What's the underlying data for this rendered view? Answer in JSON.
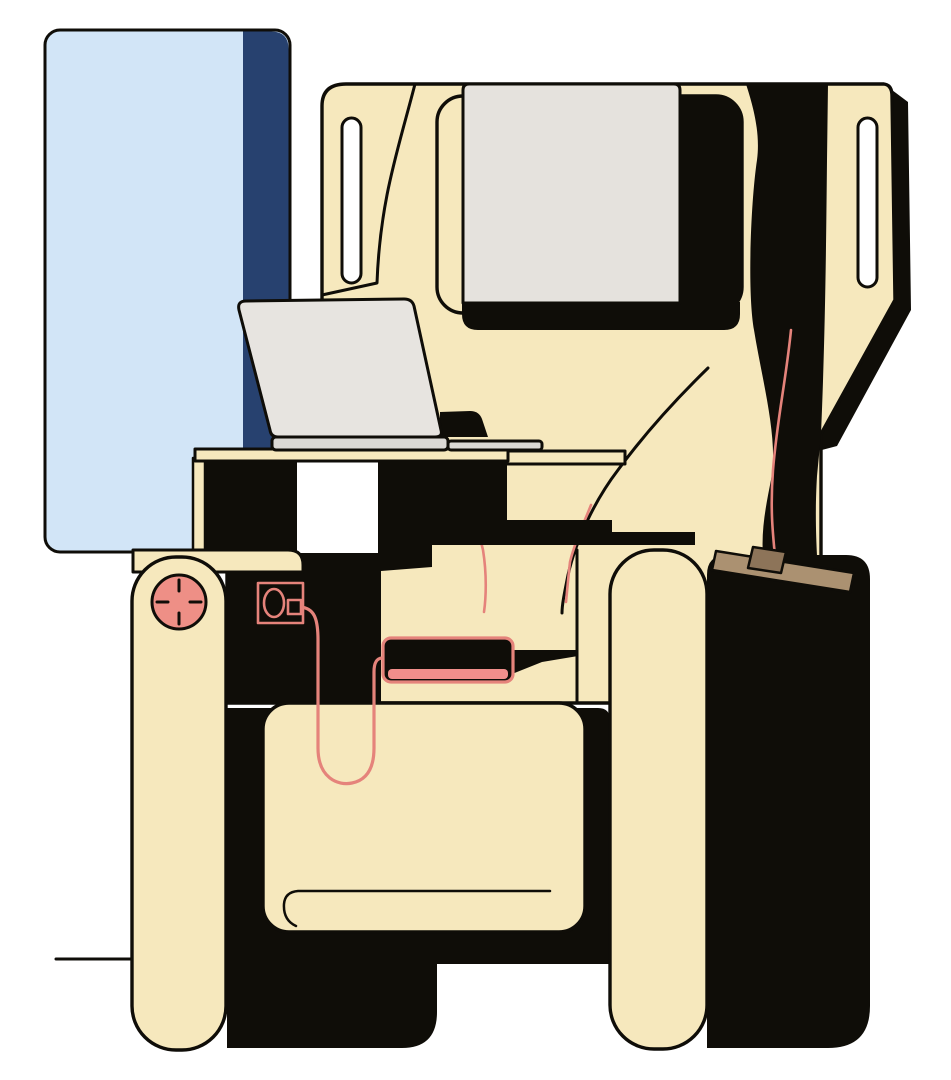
{
  "scene": {
    "description": "Flat vector illustration of an empty business-class airplane seat. A laptop sits open on the tray table, a phone with a charging cable plugged into the seat power outlet lies on the seat, a reading-light dial sits on the left armrest, and a seatbelt strap is draped over the right side console. A blue privacy partition stands behind the seat.",
    "style": "flat illustration, cream seat with black shadows and salmon accents",
    "objects": [
      "privacy-partition",
      "seat-shell",
      "headrest-screen",
      "tray-table",
      "laptop",
      "reading-light-dial",
      "power-outlet",
      "charging-cable",
      "smartphone",
      "seat-cushion",
      "left-armrest",
      "right-armrest",
      "side-console",
      "seatbelt-strap",
      "floor-line"
    ]
  },
  "colors": {
    "background": "#ffffff",
    "ink": "#0f0d08",
    "cream": "#f6e8bd",
    "partitionBlue": "#d2e5f7",
    "partitionNavy": "#27416f",
    "screenGray": "#e5e2dd",
    "laptopScreen": "#e7e4e0",
    "laptopBase": "#dbd9d5",
    "accent": "#e5837b",
    "dialPink": "#ee8f86",
    "phoneStripPink": "#f18e8b",
    "strapTan": "#ab9171",
    "strapTanDark": "#8d7459",
    "white": "#ffffff"
  }
}
